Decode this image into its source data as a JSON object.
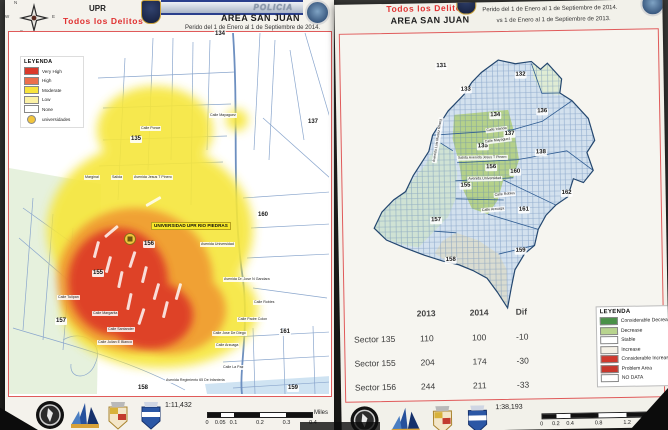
{
  "left_page": {
    "header": {
      "unit_label": "UPR",
      "crime_label": "Todos los Delitos",
      "banner_label": "POLICIA",
      "area_label": "AREA SAN JUAN",
      "period_label": "Perido del 1 de Enero al 1 de Septiembre de 2014.",
      "compass": {
        "n": "N",
        "e": "E",
        "s": "S",
        "w": "W"
      }
    },
    "legend": {
      "title": "LEYENDA",
      "items": [
        {
          "label": "Very High",
          "color": "#da3a2b"
        },
        {
          "label": "High",
          "color": "#ec6f4c"
        },
        {
          "label": "Moderate",
          "color": "#f8e43c"
        },
        {
          "label": "Low",
          "color": "#fcf2a6"
        },
        {
          "label": "None",
          "color": "#ffffff"
        },
        {
          "label": "universidades",
          "color": "#f2c53d"
        }
      ]
    },
    "sectors": [
      "134",
      "135",
      "137",
      "160",
      "156",
      "155",
      "157",
      "161",
      "158",
      "159"
    ],
    "poi_label": "UNIVERSIDAD UPR RIO PIEDRAS",
    "streets": [
      "Calle Mayaguez",
      "Calle Ponce",
      "Marginal",
      "Salida",
      "Avenida Jesus T Pinero",
      "Avenida Universidad",
      "Avenida Dr. Jose N Gandara",
      "Calle Robles",
      "Calle Margarita",
      "Calle Santander",
      "Calle Julian E Blanco",
      "Calle Tulipan",
      "Calle Padre Colon",
      "Calle Jose De Diego",
      "Calle Arzuaga",
      "Calle La Paz",
      "Avenida Regimiento 65 De Infanteria"
    ],
    "footer": {
      "scale_ratio": "1:11,432",
      "scale_ticks": [
        "0",
        "0.05",
        "0.1",
        "0.2",
        "0.3",
        "0.4"
      ],
      "scale_unit": "Miles"
    }
  },
  "right_page": {
    "header": {
      "crime_label": "Todos los Delitos",
      "area_label": "AREA SAN JUAN",
      "period_line1": "Perido del 1 de Enero al 1 de Septiembre de 2014.",
      "period_line2": "vs 1 de Enero al 1 de Septiembre de 2013."
    },
    "sectors": [
      "131",
      "133",
      "132",
      "134",
      "136",
      "137",
      "135",
      "138",
      "156",
      "160",
      "162",
      "155",
      "161",
      "157",
      "159",
      "158"
    ],
    "streets": [
      "Calle Irlanda",
      "Calle Mayaguez",
      "Salida Avenida Jesus T Pinero",
      "Avenida Universidad",
      "Calle Robles",
      "Calle Arzuaga",
      "Avenida Luis Munoz Rivera"
    ],
    "table": {
      "headers": [
        "2013",
        "2014",
        "Dif"
      ],
      "rows": [
        {
          "sector": "Sector 135",
          "y2013": "110",
          "y2014": "100",
          "dif": "-10"
        },
        {
          "sector": "Sector 155",
          "y2013": "204",
          "y2014": "174",
          "dif": "-30"
        },
        {
          "sector": "Sector 156",
          "y2013": "244",
          "y2014": "211",
          "dif": "-33"
        }
      ]
    },
    "legend": {
      "title": "LEYENDA",
      "items": [
        {
          "label": "Considerable Decrease",
          "color": "#4a9147"
        },
        {
          "label": "Decrease",
          "color": "#b8d48e"
        },
        {
          "label": "Stable",
          "color": "#ffffff"
        },
        {
          "label": "Increase",
          "color": "#f5f1e6"
        },
        {
          "label": "Considerable Increase",
          "color": "#d0392e"
        },
        {
          "label": "Problem Area",
          "color": "#c8372d"
        },
        {
          "label": "NO DATA",
          "color": "#ffffff"
        }
      ]
    },
    "footer": {
      "scale_ratio": "1:38,193",
      "scale_ticks": [
        "0",
        "0.2",
        "0.4",
        "0.8",
        "1.2",
        "1.6"
      ],
      "scale_unit": "Miles"
    }
  }
}
